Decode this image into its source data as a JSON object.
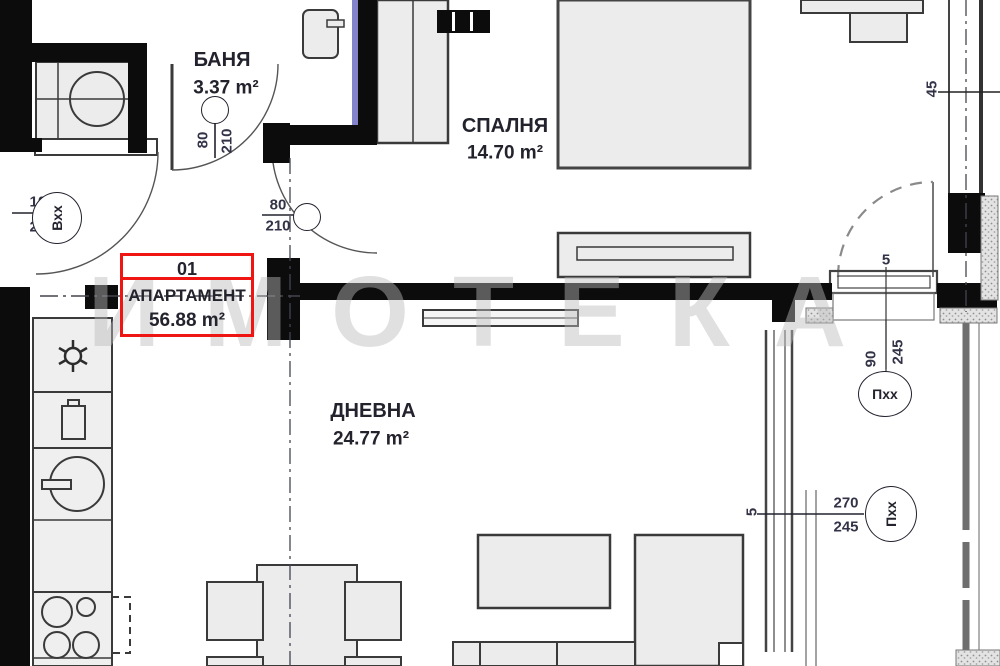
{
  "watermark": {
    "text": "ИМОТЕКА"
  },
  "apartment_label": {
    "number": "01",
    "name": "АПАРТАМЕНТ",
    "area": "56.88 m²",
    "box_color": "#ee1512"
  },
  "rooms": {
    "bathroom": {
      "name": "БАНЯ",
      "area": "3.37 m²"
    },
    "bedroom": {
      "name": "СПАЛНЯ",
      "area": "14.70 m²"
    },
    "living": {
      "name": "ДНЕВНА",
      "area": "24.77 m²"
    }
  },
  "openings": {
    "entrance_door": {
      "tag": "Вхх",
      "width": "100",
      "height": "210"
    },
    "bathroom_door": {
      "width": "80",
      "height": "210"
    },
    "hall_door": {
      "width": "80",
      "height": "210"
    },
    "bedroom_balcony_door": {
      "tag": "Пхх",
      "width": "90",
      "height": "245"
    },
    "living_room_window": {
      "tag": "Пхх",
      "width": "270",
      "height": "245"
    }
  },
  "dimensions": {
    "wall_thickness": "45",
    "sill_top": "5",
    "sill_side": "5"
  },
  "colors": {
    "wall": "#0c0c0c",
    "furniture_fill": "#ececec",
    "accent_blue": "#8283c9",
    "watermark_gray": "#bcbcbc"
  }
}
